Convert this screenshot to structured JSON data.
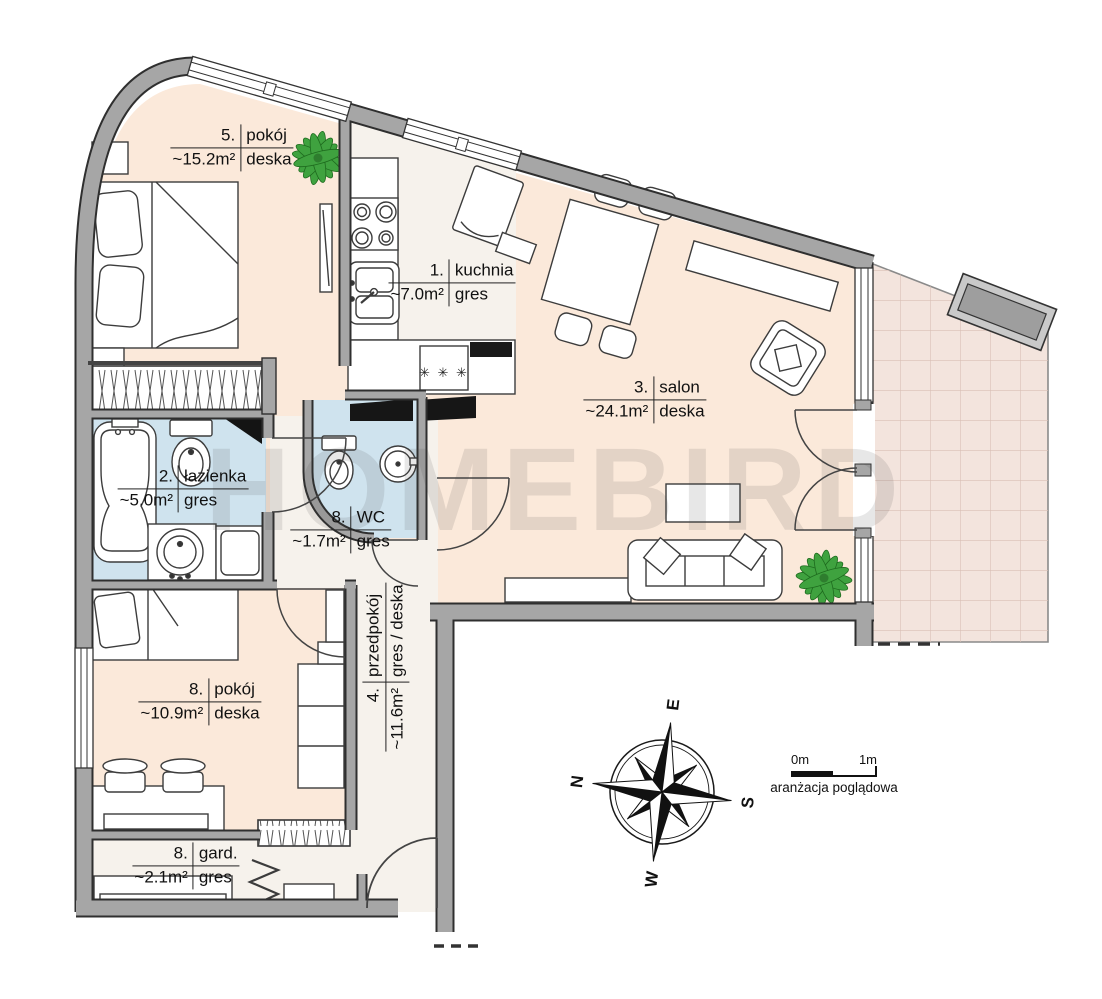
{
  "watermark": "HOMEBIRD",
  "rooms": [
    {
      "number": "5.",
      "name": "pokój",
      "area": "~15.2m²",
      "floor": "deska"
    },
    {
      "number": "1.",
      "name": "kuchnia",
      "area": "~7.0m²",
      "floor": "gres"
    },
    {
      "number": "3.",
      "name": "salon",
      "area": "~24.1m²",
      "floor": "deska"
    },
    {
      "number": "2.",
      "name": "łazienka",
      "area": "~5.0m²",
      "floor": "gres"
    },
    {
      "number": "8.",
      "name": "WC",
      "area": "~1.7m²",
      "floor": "gres"
    },
    {
      "number": "4.",
      "name": "przedpokój",
      "area": "~11.6m²",
      "floor": "gres / deska"
    },
    {
      "number": "8.",
      "name": "pokój",
      "area": "~10.9m²",
      "floor": "deska"
    },
    {
      "number": "8.",
      "name": "gard.",
      "area": "~2.1m²",
      "floor": "gres"
    }
  ],
  "compass": {
    "north": "N",
    "east": "E",
    "south": "S",
    "west": "W"
  },
  "scale": {
    "start": "0m",
    "end": "1m",
    "caption": "aranżacja poglądowa"
  },
  "symbols": {
    "freezer_stars": "✳ ✳ ✳"
  },
  "colors": {
    "wall": "#a6a6a6",
    "floor_wood": "#fbe9da",
    "floor_gres": "#f6f2ec",
    "floor_bath": "#cfe3ee",
    "terrace": "#f3e4dd",
    "plant": "#3fa23f"
  }
}
